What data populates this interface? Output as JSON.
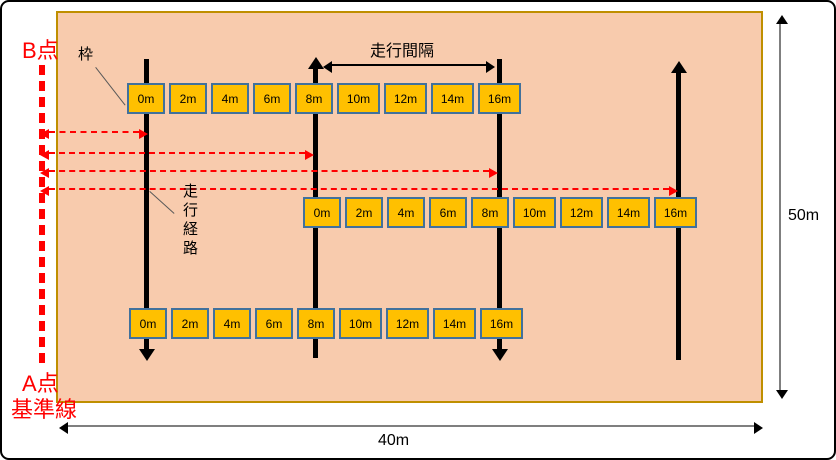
{
  "diagram": {
    "labels": {
      "point_b": "B点",
      "point_a": "A点",
      "baseline": "基準線",
      "frame": "枠",
      "travel_interval": "走行間隔",
      "travel_route": "走行経路",
      "field_width": "40m",
      "field_height": "50m"
    },
    "marker_rows": {
      "top": [
        "0m",
        "2m",
        "4m",
        "6m",
        "8m",
        "10m",
        "12m",
        "14m",
        "16m"
      ],
      "middle": [
        "0m",
        "2m",
        "4m",
        "6m",
        "8m",
        "10m",
        "12m",
        "14m",
        "16m"
      ],
      "bottom": [
        "0m",
        "2m",
        "4m",
        "6m",
        "8m",
        "10m",
        "12m",
        "14m",
        "16m"
      ]
    },
    "colors": {
      "field_fill": "#F8CBAD",
      "field_border": "#BF8F00",
      "marker_fill": "#FFC000",
      "marker_border": "#41719C",
      "accent_red": "#FF0000",
      "dimension_gray": "#7F7F7F",
      "route_black": "#000000"
    }
  }
}
